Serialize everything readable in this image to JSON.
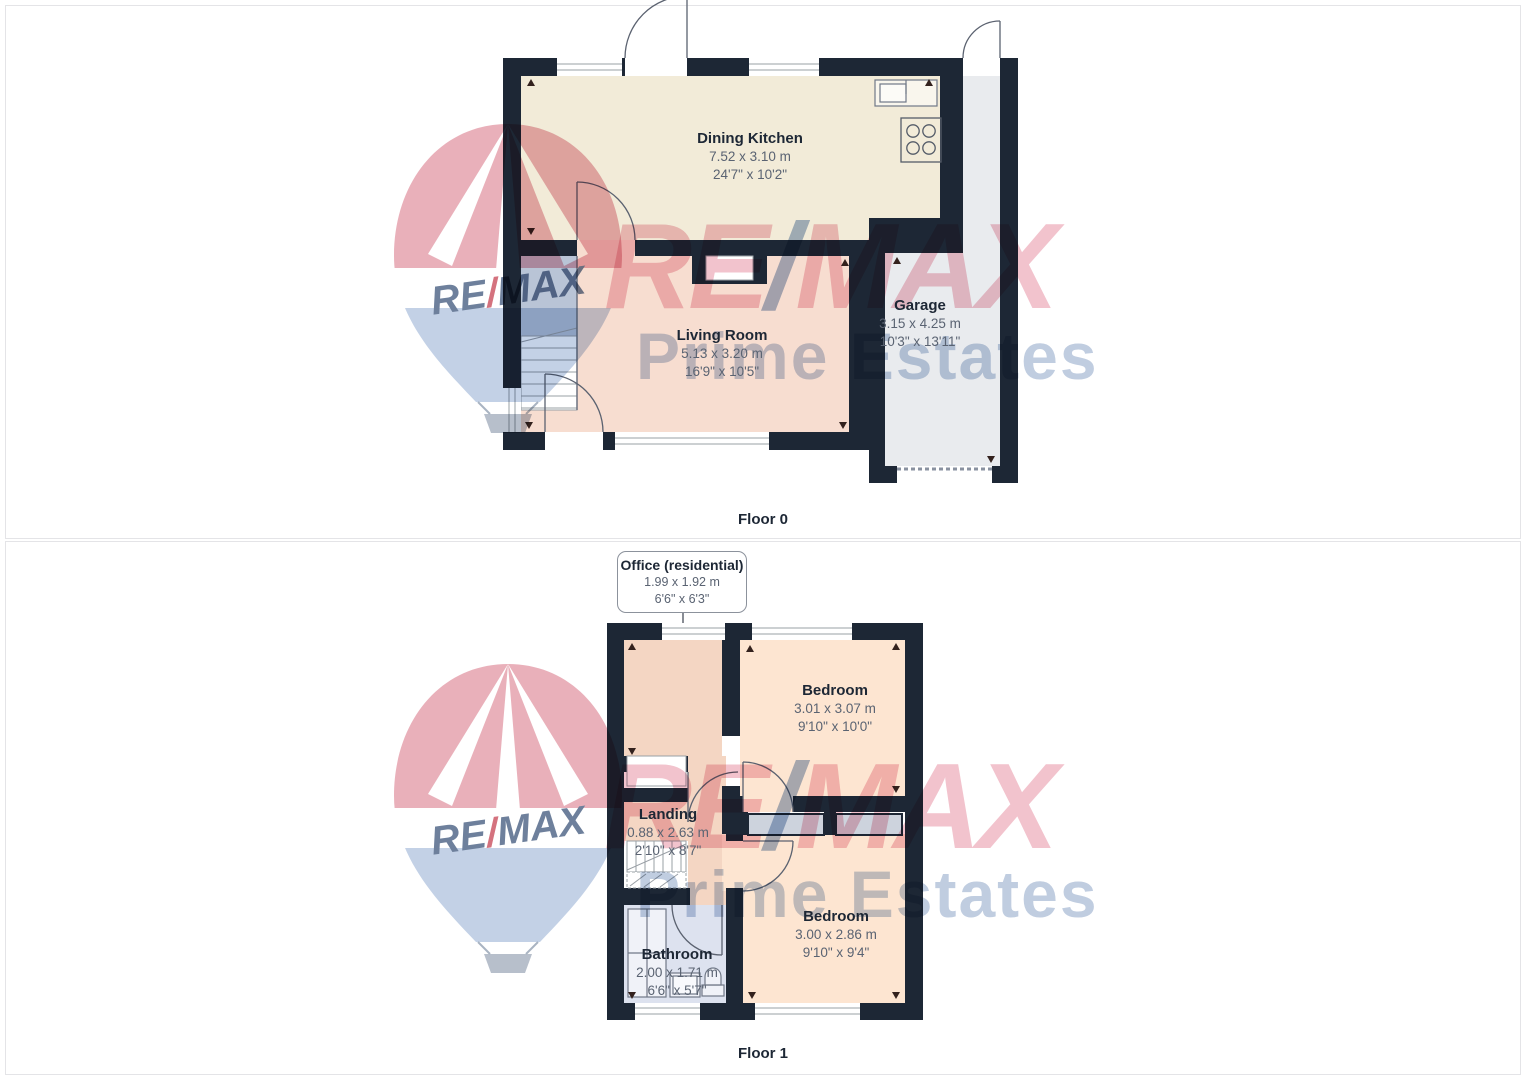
{
  "watermark": {
    "re": "RE",
    "slash": "/",
    "max": "MAX",
    "subbrand": "Prime Estates"
  },
  "floor0": {
    "label": "Floor 0",
    "rooms": {
      "dining_kitchen": {
        "name": "Dining Kitchen",
        "metric": "7.52 x 3.10 m",
        "imperial": "24'7\" x 10'2\""
      },
      "living_room": {
        "name": "Living Room",
        "metric": "5.13 x 3.20 m",
        "imperial": "16'9\" x 10'5\""
      },
      "garage": {
        "name": "Garage",
        "metric": "3.15 x 4.25 m",
        "imperial": "10'3\" x 13'11\""
      }
    }
  },
  "floor1": {
    "label": "Floor 1",
    "callout": {
      "name": "Office (residential)",
      "metric": "1.99 x 1.92 m",
      "imperial": "6'6\" x 6'3\""
    },
    "rooms": {
      "bedroom_top": {
        "name": "Bedroom",
        "metric": "3.01 x 3.07 m",
        "imperial": "9'10\" x 10'0\""
      },
      "landing": {
        "name": "Landing",
        "metric": "0.88 x 2.63 m",
        "imperial": "2'10\" x 8'7\""
      },
      "bedroom_bottom": {
        "name": "Bedroom",
        "metric": "3.00 x 2.86 m",
        "imperial": "9'10\" x 9'4\""
      },
      "bathroom": {
        "name": "Bathroom",
        "metric": "2.00 x 1.71 m",
        "imperial": "6'6\" x 5'7\""
      }
    }
  },
  "colors": {
    "wall": "#1d2735",
    "kitchen": "#f2ebd8",
    "living": "#f7ddd0",
    "garage": "#e9ebee",
    "bedroom": "#fde5d1",
    "office_landing": "#f4d6c3",
    "bathroom": "#dde2ef",
    "stairs": "#b9c4d6",
    "wardrobe": "#cdd3dd",
    "watermark_red": "#f2c3cd",
    "watermark_blue": "#c0cde0"
  }
}
